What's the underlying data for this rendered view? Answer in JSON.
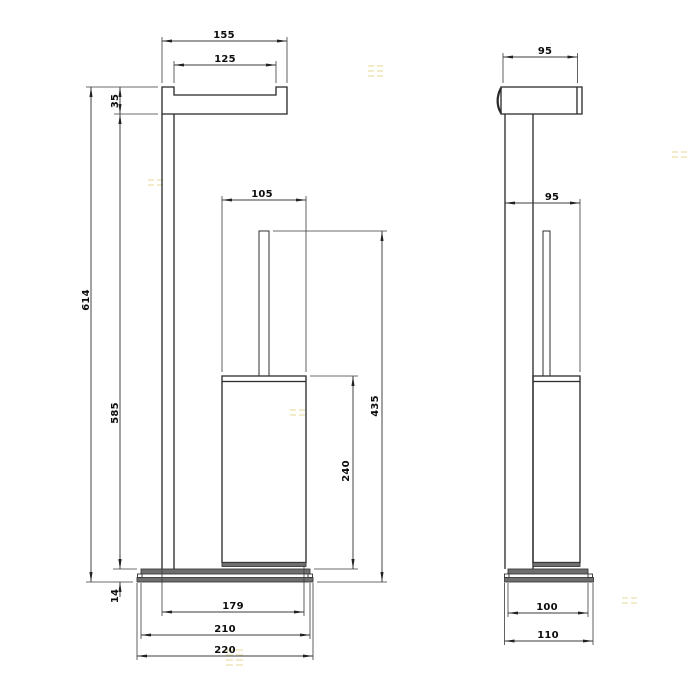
{
  "front_view": {
    "dims": {
      "top_width_outer": "155",
      "top_width_inner": "125",
      "top_height": "35",
      "overall_height": "614",
      "column_height": "585",
      "container_width": "105",
      "brush_total_height": "435",
      "container_height": "240",
      "base_height": "14",
      "base_width_inner": "179",
      "base_width_mid": "210",
      "base_width_outer": "220"
    }
  },
  "side_view": {
    "dims": {
      "top_depth": "95",
      "body_depth": "95",
      "base_depth_inner": "100",
      "base_depth_outer": "110"
    }
  }
}
